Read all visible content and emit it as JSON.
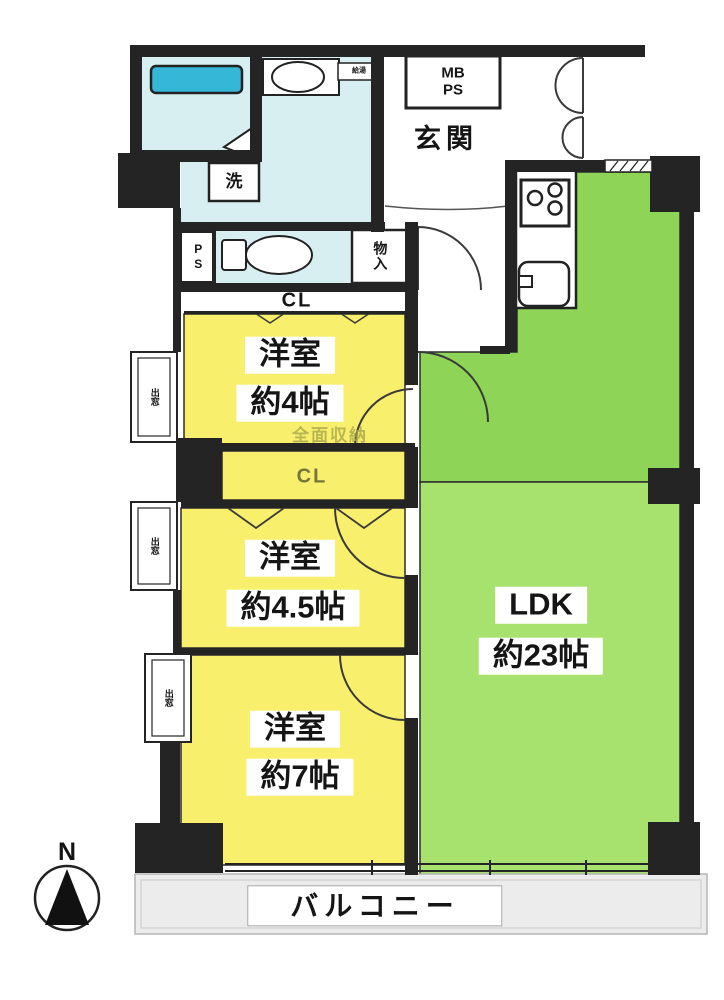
{
  "colors": {
    "room_yellow": "#f8ef6c",
    "ldk_green_upper": "#8ed457",
    "ldk_green_lower": "#a7e16e",
    "sanitary_blue": "#d8eff2",
    "bathtub_blue": "#35b8d8",
    "balcony_gray": "#ececec",
    "wall_black": "#242424"
  },
  "labels": {
    "entrance": "玄関",
    "mb": "MB",
    "ps_meter": "PS",
    "washer": "洗",
    "pipe_space": "PS",
    "storage": "物入",
    "closet_top": "CL",
    "closet_mid": "CL",
    "wall_storage_note": "全面収納",
    "water_heater": "給湯",
    "balcony": "バルコニー",
    "bay_window": "出窓",
    "compass_north": "N"
  },
  "rooms": [
    {
      "name": "洋室",
      "size": "約4帖"
    },
    {
      "name": "洋室",
      "size": "約4.5帖"
    },
    {
      "name": "洋室",
      "size": "約7帖"
    },
    {
      "name": "LDK",
      "size": "約23帖"
    }
  ]
}
